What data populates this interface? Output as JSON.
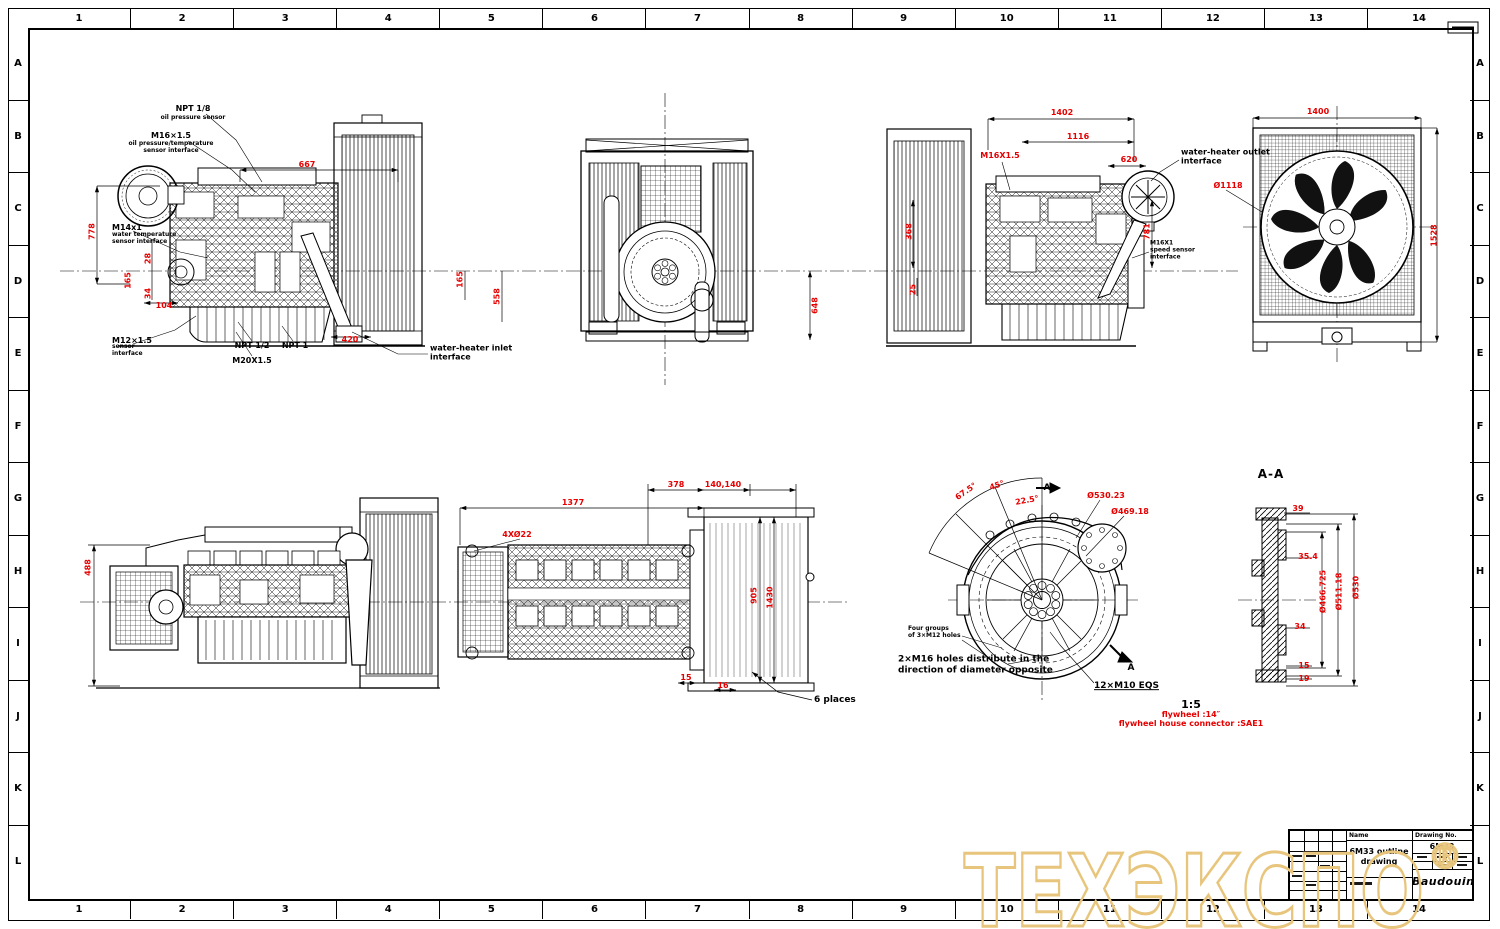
{
  "page": {
    "background": "#ffffff",
    "line_color": "#000000",
    "dimension_color": "#e60000",
    "watermark_color": "#e8c57c"
  },
  "frame": {
    "columns": [
      "1",
      "2",
      "3",
      "4",
      "5",
      "6",
      "7",
      "8",
      "9",
      "10",
      "11",
      "12",
      "13",
      "14"
    ],
    "rows": [
      "A",
      "B",
      "C",
      "D",
      "E",
      "F",
      "G",
      "H",
      "I",
      "J",
      "K",
      "L"
    ]
  },
  "watermark": {
    "text": "ТЕХЭКСПО",
    "reg": "®"
  },
  "title_block": {
    "name_label": "Name",
    "name_value": "6M33 outline\ndrawing",
    "drawing_no_label": "Drawing No.",
    "drawing_no_value": "6M33",
    "brand": "Baudouin"
  },
  "callouts": [
    {
      "t": "NPT 1/8",
      "x": 193,
      "y": 109,
      "c": "b",
      "n": "callout-npt-1-8"
    },
    {
      "t": "oil pressure sensor",
      "x": 193,
      "y": 118,
      "c": "s",
      "n": "callout-oil-pressure-sensor"
    },
    {
      "t": "M16×1.5",
      "x": 171,
      "y": 136,
      "c": "b",
      "n": "callout-m16x15"
    },
    {
      "t": "oil pressure/temperature\nsensor interface",
      "x": 171,
      "y": 148,
      "c": "s",
      "n": "callout-oil-press-temp"
    },
    {
      "t": "M14x1",
      "x": 112,
      "y": 228,
      "c": "b l",
      "n": "callout-m14x1"
    },
    {
      "t": "water temperature\nsensor interface",
      "x": 112,
      "y": 239,
      "c": "s l",
      "n": "callout-water-temp"
    },
    {
      "t": "M12×1.5",
      "x": 112,
      "y": 341,
      "c": "b l",
      "n": "callout-m12x15"
    },
    {
      "t": "sensor\ninterface",
      "x": 112,
      "y": 351,
      "c": "s l",
      "n": "callout-m12-sub"
    },
    {
      "t": "NPT 1/2",
      "x": 252,
      "y": 346,
      "c": "b",
      "n": "callout-npt-1-2"
    },
    {
      "t": "NPT 1",
      "x": 295,
      "y": 346,
      "c": "b",
      "n": "callout-npt-1"
    },
    {
      "t": "M20X1.5",
      "x": 252,
      "y": 361,
      "c": "b",
      "n": "callout-m20x15"
    },
    {
      "t": "water-heater inlet\ninterface",
      "x": 430,
      "y": 354,
      "c": "b l",
      "n": "callout-water-heater-inlet"
    },
    {
      "t": "water-heater outlet\ninterface",
      "x": 1181,
      "y": 158,
      "c": "b l",
      "n": "callout-water-heater-outlet"
    },
    {
      "t": "M16X1\nspeed sensor\ninterface",
      "x": 1150,
      "y": 251,
      "c": "s l",
      "n": "callout-m16x1"
    },
    {
      "t": "Four groups\nof 3×M12 holes",
      "x": 908,
      "y": 633,
      "c": "s l",
      "n": "callout-four-groups"
    },
    {
      "t": "2×M16 holes distribute in the\ndirection of diameter opposite",
      "x": 898,
      "y": 666,
      "c": "n9 l",
      "n": "note-m16-holes"
    },
    {
      "t": "12×M10 EQS",
      "x": 1094,
      "y": 687,
      "c": "n9 l u",
      "n": "note-12xm10-eqs"
    },
    {
      "t": "A-A",
      "x": 1271,
      "y": 475,
      "c": "n12",
      "n": "section-title-aa"
    },
    {
      "t": "1:5",
      "x": 1191,
      "y": 706,
      "c": "n11",
      "n": "note-scale"
    },
    {
      "t": "6 places",
      "x": 814,
      "y": 701,
      "c": "n9 l",
      "n": "note-6-places"
    },
    {
      "t": "A",
      "x": 1047,
      "y": 489,
      "c": "n9",
      "n": "section-arrow-a-top"
    },
    {
      "t": "A",
      "x": 1131,
      "y": 669,
      "c": "n9",
      "n": "section-arrow-a-bottom"
    }
  ],
  "dims": [
    {
      "t": "667",
      "x": 307,
      "y": 165
    },
    {
      "t": "778",
      "x": 92,
      "y": 232,
      "rot": -90
    },
    {
      "t": "28",
      "x": 148,
      "y": 259,
      "rot": -90
    },
    {
      "t": "165",
      "x": 128,
      "y": 281,
      "rot": -90
    },
    {
      "t": "34",
      "x": 148,
      "y": 294,
      "rot": -90
    },
    {
      "t": "104",
      "x": 164,
      "y": 306
    },
    {
      "t": "420",
      "x": 350,
      "y": 340
    },
    {
      "t": "165",
      "x": 460,
      "y": 280,
      "rot": -90
    },
    {
      "t": "558",
      "x": 497,
      "y": 297,
      "rot": -90
    },
    {
      "t": "648",
      "x": 815,
      "y": 306,
      "rot": -90
    },
    {
      "t": "1402",
      "x": 1062,
      "y": 113
    },
    {
      "t": "1116",
      "x": 1078,
      "y": 137
    },
    {
      "t": "M16X1.5",
      "x": 1000,
      "y": 156
    },
    {
      "t": "620",
      "x": 1129,
      "y": 160
    },
    {
      "t": "368",
      "x": 909,
      "y": 232,
      "rot": -90
    },
    {
      "t": "781",
      "x": 1147,
      "y": 232,
      "rot": -90
    },
    {
      "t": "25",
      "x": 913,
      "y": 290,
      "rot": -90
    },
    {
      "t": "Ø1118",
      "x": 1228,
      "y": 186
    },
    {
      "t": "1400",
      "x": 1318,
      "y": 112
    },
    {
      "t": "1528",
      "x": 1434,
      "y": 236,
      "rot": -90
    },
    {
      "t": "488",
      "x": 88,
      "y": 568,
      "rot": -90
    },
    {
      "t": "1377",
      "x": 573,
      "y": 503
    },
    {
      "t": "4XØ22",
      "x": 517,
      "y": 535
    },
    {
      "t": "378",
      "x": 676,
      "y": 485
    },
    {
      "t": "140,140",
      "x": 723,
      "y": 485
    },
    {
      "t": "905",
      "x": 754,
      "y": 596,
      "rot": -90
    },
    {
      "t": "1430",
      "x": 770,
      "y": 598,
      "rot": -90
    },
    {
      "t": "15",
      "x": 686,
      "y": 678
    },
    {
      "t": "16",
      "x": 723,
      "y": 686
    },
    {
      "t": "67.5°",
      "x": 966,
      "y": 492,
      "rot": -35
    },
    {
      "t": "45°",
      "x": 997,
      "y": 486,
      "rot": -20
    },
    {
      "t": "22.5°",
      "x": 1027,
      "y": 501,
      "rot": -10
    },
    {
      "t": "Ø530.23",
      "x": 1106,
      "y": 496
    },
    {
      "t": "Ø469.18",
      "x": 1130,
      "y": 512
    },
    {
      "t": "39",
      "x": 1298,
      "y": 509
    },
    {
      "t": "35.4",
      "x": 1308,
      "y": 557
    },
    {
      "t": "34",
      "x": 1300,
      "y": 627
    },
    {
      "t": "15",
      "x": 1304,
      "y": 666
    },
    {
      "t": "19",
      "x": 1304,
      "y": 679
    },
    {
      "t": "Ø466.725",
      "x": 1323,
      "y": 592,
      "rot": -90
    },
    {
      "t": "Ø511.18",
      "x": 1339,
      "y": 592,
      "rot": -90
    },
    {
      "t": "Ø530",
      "x": 1356,
      "y": 588,
      "rot": -90
    },
    {
      "t": "flywheel :14″",
      "x": 1191,
      "y": 715
    },
    {
      "t": "flywheel house connector :SAE1",
      "x": 1191,
      "y": 724
    }
  ]
}
